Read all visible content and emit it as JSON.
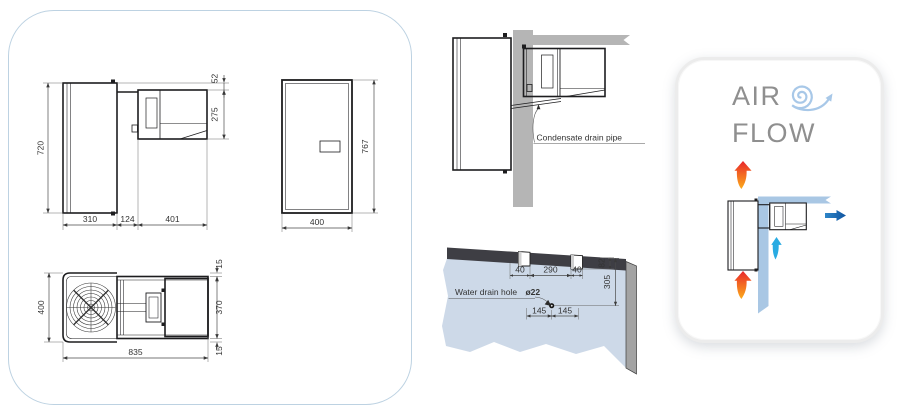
{
  "left_panel": {
    "side_view": {
      "height": "720",
      "top_gap": "52",
      "unit_height": "275",
      "depth_in": "310",
      "wall": "124",
      "depth_out": "401"
    },
    "front_view": {
      "height": "767",
      "width": "400"
    },
    "top_view": {
      "width": "400",
      "top_margin": "15",
      "body": "370",
      "bottom_margin": "15",
      "length": "835"
    }
  },
  "installation": {
    "condensate_label": "Condensate drain pipe",
    "water_drain": {
      "label": "Water drain hole",
      "hole": "ø22",
      "left": "40",
      "center": "290",
      "right": "40",
      "notch_depth": "82",
      "drop": "305",
      "off_left": "145",
      "off_right": "145"
    }
  },
  "airflow": {
    "word1": "AIR",
    "word2": "FLOW"
  },
  "colors": {
    "panel_border": "#bdd2e2",
    "drawing_line": "#1d1d1f",
    "dim_text": "#333333",
    "wall_gray": "#b5b5b5",
    "wall_blue_face": "#cdd9e8",
    "wall_top_band": "#3e3e44",
    "wall_side_band": "#a3a3a3",
    "flow_wall_blue": "#a9c7e4",
    "spiral_blue": "#a8c8e8",
    "arrow_red": "#e8252c",
    "arrow_orange": "#fbab1c",
    "arrow_cyan": "#29abe2",
    "arrow_dark_blue": "#1b6eb5",
    "airflow_text": "#8f8f8f"
  }
}
